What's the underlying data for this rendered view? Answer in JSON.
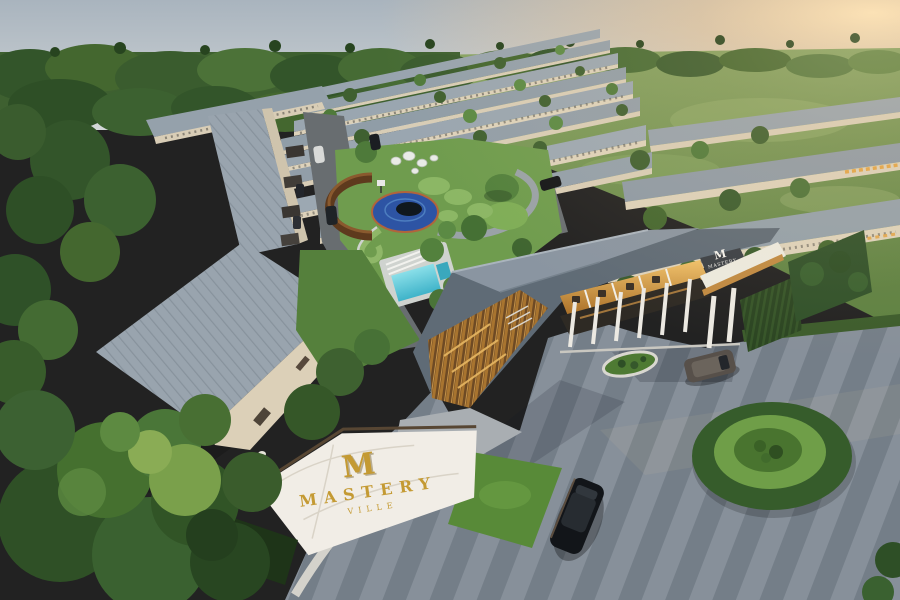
{
  "scene": {
    "type": "aerial-3d-architectural-rendering",
    "description": "Bird's-eye dusk rendering of a gated residential village with parallel rows of grey-roofed townhomes, central playground with circular blue court, swimming pool, timber-slat clubhouse entrance gate, striped paver driveway, round hedge island and a marble project monument sign"
  },
  "branding": {
    "project_name": "MASTERY VILLE",
    "monument_sign": {
      "logo_letter": "M",
      "name_line": "MASTERY",
      "sub_line": "VILLE"
    },
    "clubhouse_sign": {
      "logo_letter": "M",
      "name_line": "MASTERY",
      "sub_line": "VILLE"
    }
  },
  "palette": {
    "sky_top": "#a9b4be",
    "sky_bottom": "#d3d7d8",
    "sun_glow": "#f6cd96",
    "forest_dark": "#33552a",
    "forest_mid": "#466b34",
    "field_green": "#7d9c59",
    "lawn_green": "#6f9c4e",
    "roof_light": "#9aa6b0",
    "roof_dark": "#5f6b76",
    "wall_cream": "#e0d5bf",
    "wood_slat": "#a8742f",
    "warm_light": "#e7b763",
    "court_blue": "#2d54a4",
    "court_center": "#10181f",
    "pool_teal": "#4fc4da",
    "asphalt": "#6a6f72",
    "paver_light": "#87909a",
    "paver_dark": "#747e88",
    "marble_white": "#f1ede6",
    "gold": "#c49a33",
    "hedge_dark": "#2b4522",
    "car_black": "#121519"
  }
}
